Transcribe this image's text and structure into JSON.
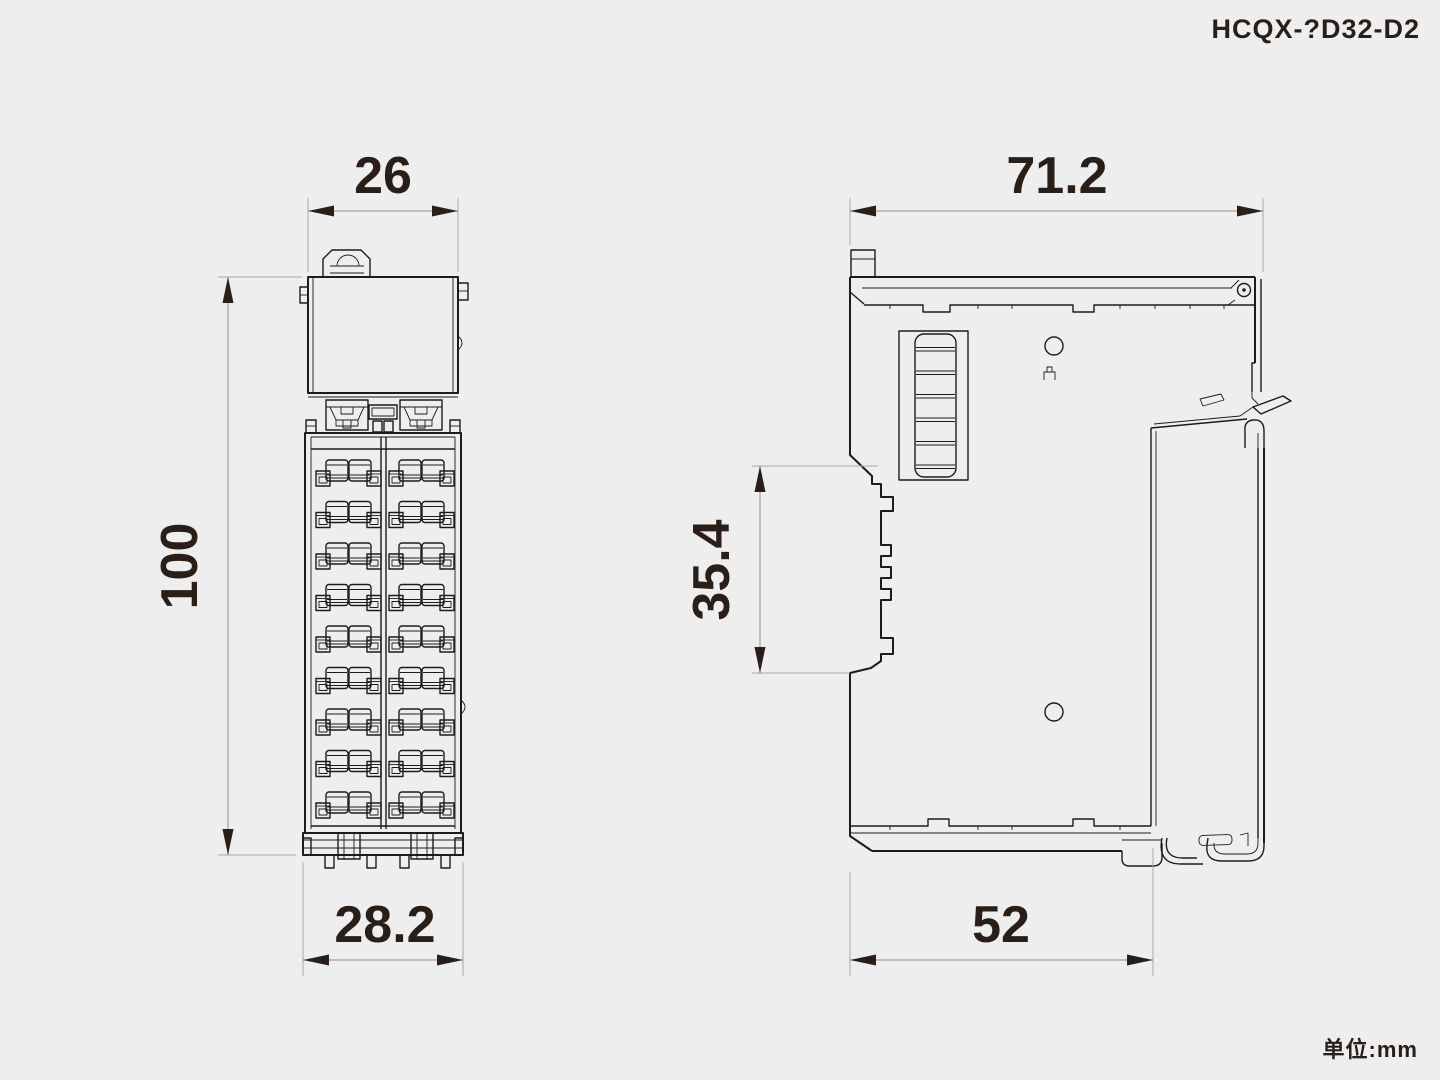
{
  "title": "HCQX-?D32-D2",
  "unit_label": "单位:mm",
  "colors": {
    "background": "#eeeeee",
    "drawing_line": "#1c1c1c",
    "dimension_line": "#a8a8a8",
    "text": "#2a1f18"
  },
  "views": {
    "front": {
      "label": "front-view",
      "dims": {
        "top_width": "26",
        "height": "100",
        "bottom_width": "28.2"
      }
    },
    "side": {
      "label": "side-view",
      "dims": {
        "top_width": "71.2",
        "din_height": "35.4",
        "bottom_width": "52"
      }
    }
  },
  "dims": {
    "front_top_width": "26",
    "front_height": "100",
    "front_bottom_width": "28.2",
    "side_top_width": "71.2",
    "side_din_height": "35.4",
    "side_bottom_width": "52"
  }
}
